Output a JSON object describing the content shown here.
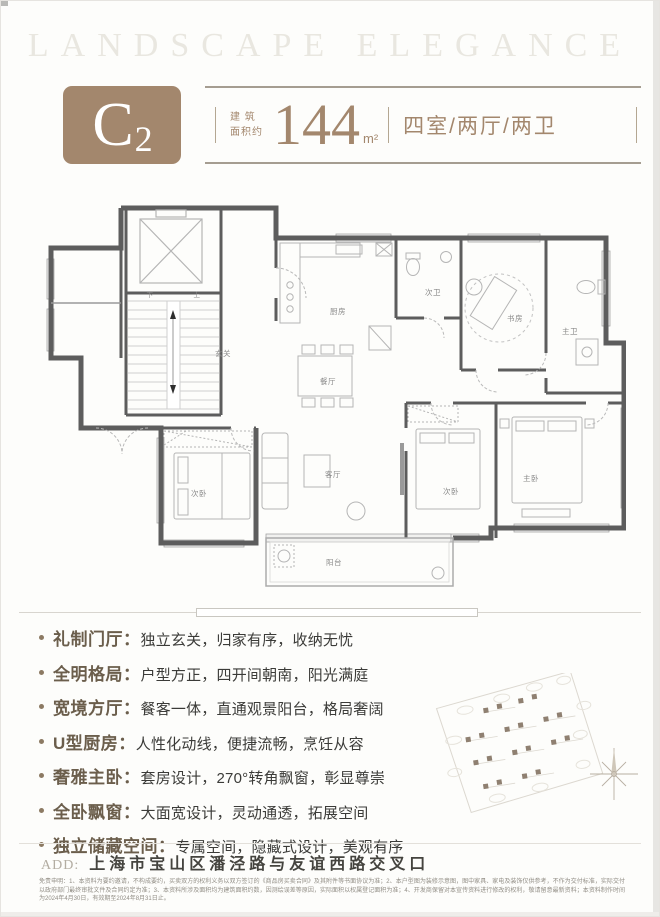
{
  "wordmark": "LANDSCAPE ELEGANCE",
  "header": {
    "unit_letter": "C",
    "unit_number": "2",
    "area_label_line1": "建 筑",
    "area_label_line2": "面积约",
    "area_value": "144",
    "area_unit": "m²",
    "rooms_text": "四室/两厅/两卫"
  },
  "floor_plan": {
    "labels": {
      "entry": "玄关",
      "kitchen": "厨房",
      "dining": "餐厅",
      "living": "客厅",
      "balcony": "阳台",
      "bedroom_left": "次卧",
      "bedroom_mid": "次卧",
      "master_bedroom": "主卧",
      "study": "书房",
      "second_bath": "次卫",
      "master_bath": "主卫",
      "stair_down": "下",
      "stair_up": "上"
    }
  },
  "features": [
    {
      "title": "礼制门厅：",
      "desc": "独立玄关，归家有序，收纳无忧"
    },
    {
      "title": "全明格局：",
      "desc": "户型方正，四开间朝南，阳光满庭"
    },
    {
      "title": "宽境方厅：",
      "desc": "餐客一体，直通观景阳台，格局奢阔"
    },
    {
      "title": "U型厨房：",
      "desc": "人性化动线，便捷流畅，烹饪从容"
    },
    {
      "title": "奢雅主卧：",
      "desc": "套房设计，270°转角飘窗，彰显尊崇"
    },
    {
      "title": "全卧飘窗：",
      "desc": "大面宽设计，灵动通透，拓展空间"
    },
    {
      "title": "独立储藏空间：",
      "desc": "专属空间，隐藏式设计，美观有序"
    }
  ],
  "address": {
    "label": "ADD:",
    "text": "上海市宝山区潘泾路与友谊西路交叉口"
  },
  "fine_print": "免责申明：1、本资料为要约邀请，不构成要约，买卖双方的权利义务以双方签订的《商品房买卖合同》及其附件等书面协议为准；2、本户型图为装修示意图，图中家具、家电及装饰仅供参考，不作为交付标准，实际交付以政府部门最终审批文件及合同约定为准；3、本资料所涉及面积均为建筑面积约数，因测绘误差等原因，实际面积以权属登记面积为准；4、开发商保留对本宣传资料进行修改的权利，敬请留意最新资料；本资料制作时间为2024年4月30日，有效期至2024年8月31日止。",
  "colors": {
    "accent": "#a3876d",
    "feature_title": "#6b5e4c",
    "text_dark": "#3b3b38",
    "wall": "#5d5d5d"
  }
}
